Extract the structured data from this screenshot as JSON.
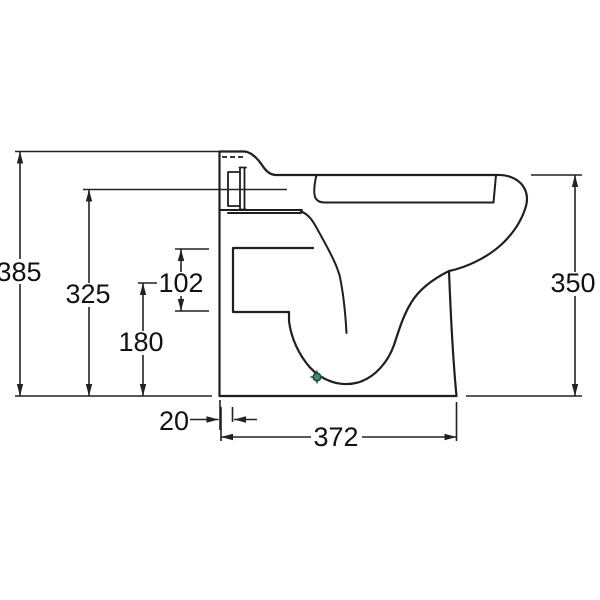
{
  "drawing": {
    "dimension_labels": {
      "overall_height": "385",
      "mid_height": "325",
      "lower_height": "180",
      "recess_height": "102",
      "front_height": "350",
      "back_offset": "20",
      "base_depth": "372"
    },
    "colors": {
      "line": "#1f1f1f",
      "text": "#111111",
      "marker_fill": "#3f8a76",
      "marker_stroke": "#1c4a40",
      "background": "#ffffff"
    }
  }
}
